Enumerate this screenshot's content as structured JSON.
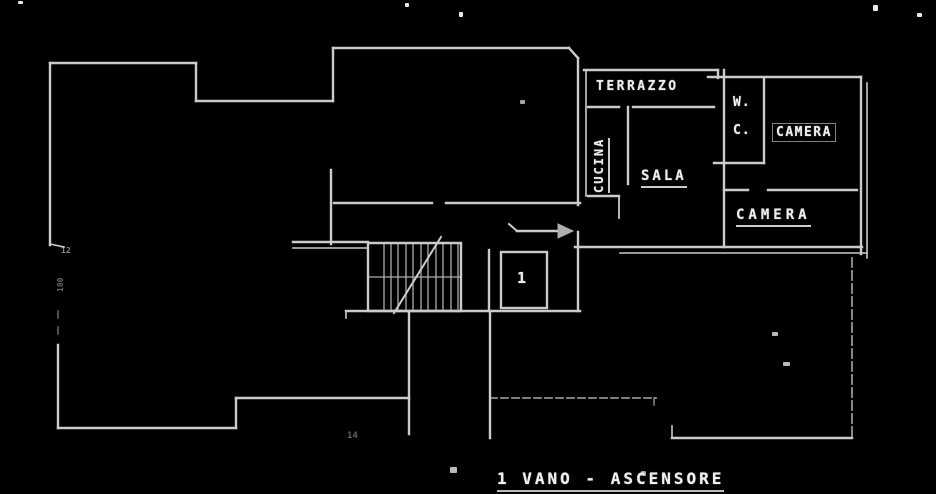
{
  "drawing": {
    "type": "floor-plan",
    "background_color": "#000000",
    "line_color": "#dedede",
    "rooms": {
      "terrazzo": "TERRAZZO",
      "cucina": "CUCINA",
      "sala": "SALA",
      "wc_line1": "W.",
      "wc_line2": "C.",
      "camera_top": "CAMERA",
      "camera_bottom": "CAMERA",
      "elevator_number": "1"
    },
    "caption": "1 VANO - ASCENSORE",
    "annotations": {
      "dim_left_top": "12",
      "dim_left_mid": "180",
      "dim_bottom_left": "14"
    }
  }
}
